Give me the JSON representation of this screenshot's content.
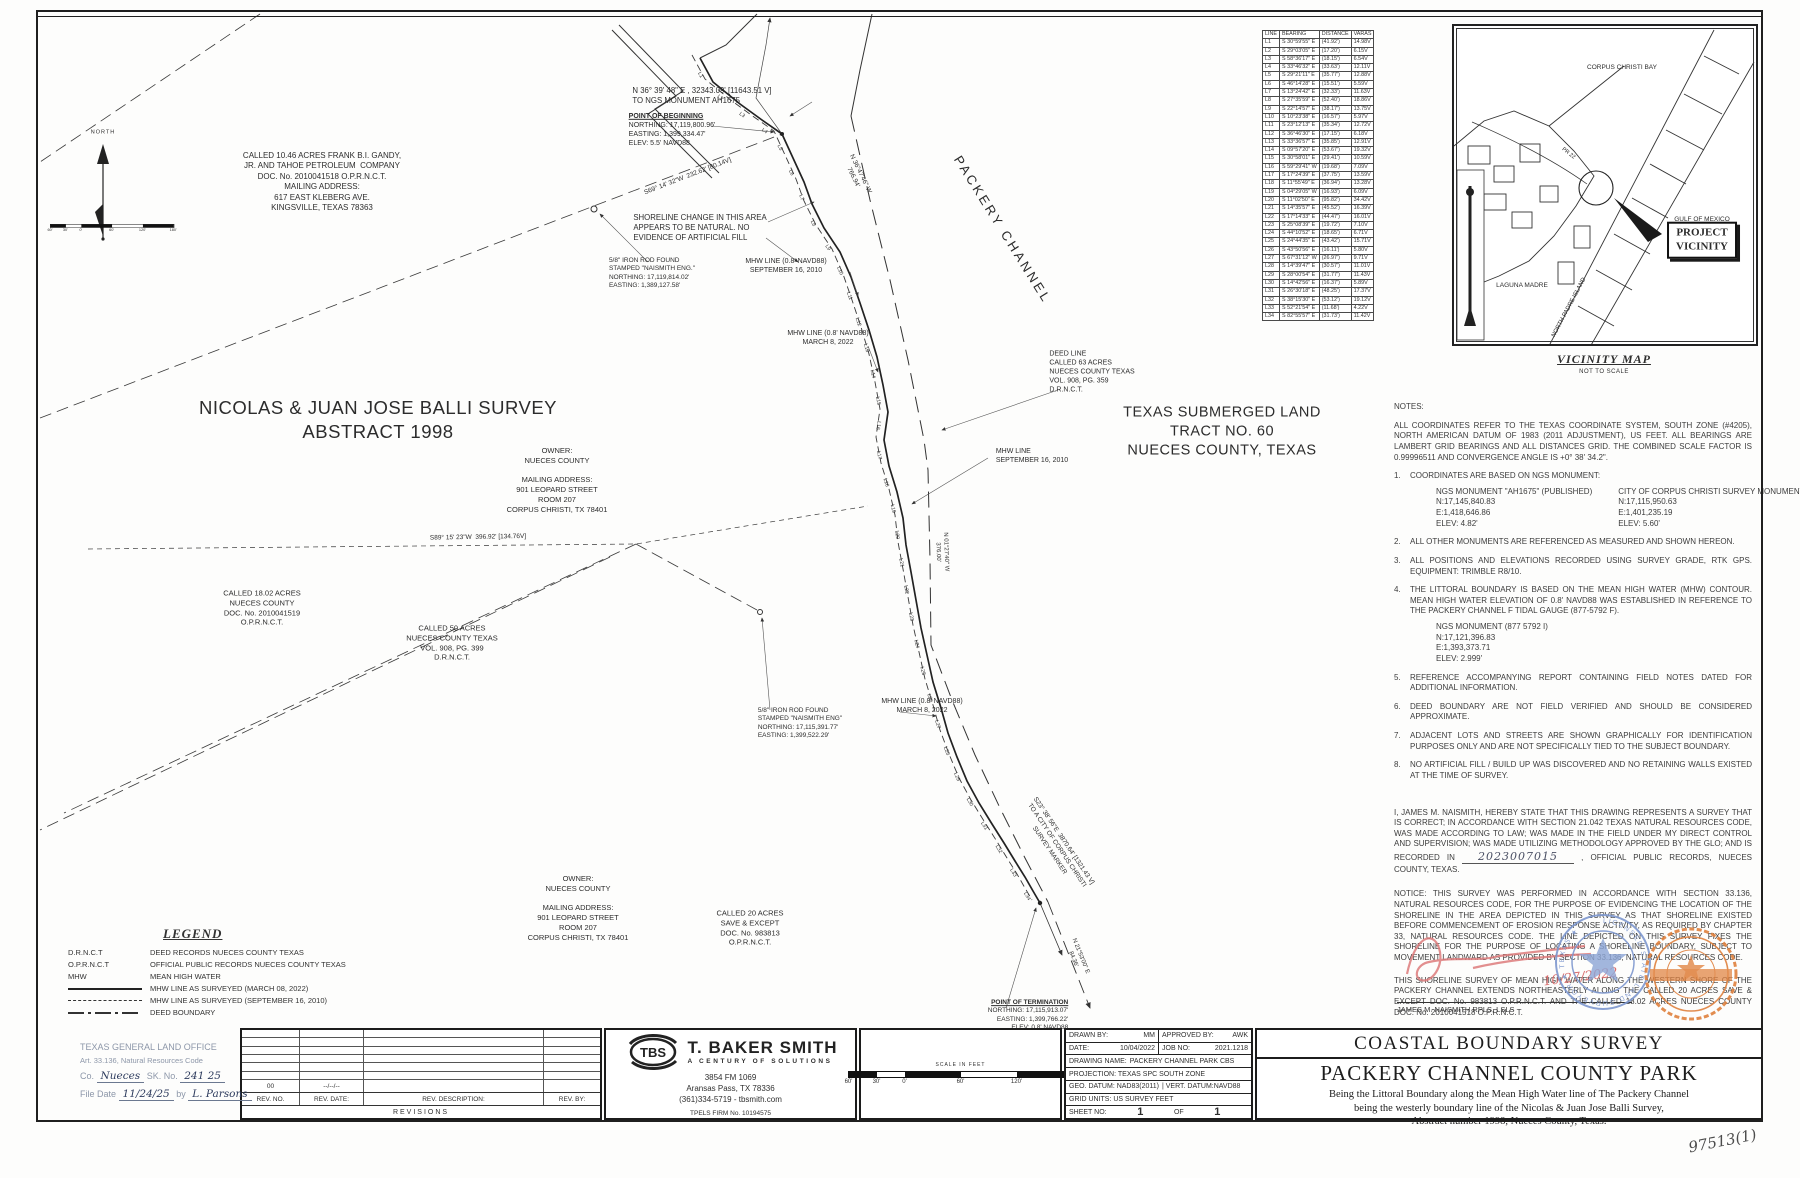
{
  "handnote": "97513(1)",
  "line_table": {
    "headers": [
      "LINE",
      "BEARING",
      "DISTANCE",
      "VARAS"
    ],
    "rows": [
      [
        "L1",
        "S 30°59'55\" E",
        "(41.92')",
        "14.98V"
      ],
      [
        "L2",
        "S 29°03'05\" E",
        "(17.20')",
        "6.15V"
      ],
      [
        "L3",
        "S 58°36'17\" E",
        "(18.15')",
        "6.54V"
      ],
      [
        "L4",
        "S 33°46'32\" E",
        "(33.63')",
        "12.11V"
      ],
      [
        "L5",
        "S 29°21'11\" E",
        "(35.77')",
        "12.88V"
      ],
      [
        "L6",
        "S 46°14'28\" E",
        "(15.51')",
        "5.59V"
      ],
      [
        "L7",
        "S 13°24'42\" E",
        "(32.33')",
        "11.63V"
      ],
      [
        "L8",
        "S 27°35'59\" E",
        "(52.40')",
        "18.86V"
      ],
      [
        "L9",
        "S 22°14'57\" E",
        "(38.17')",
        "13.75V"
      ],
      [
        "L10",
        "S 10°23'38\" E",
        "(16.57')",
        "5.97V"
      ],
      [
        "L11",
        "S 23°12'13\" E",
        "(35.34')",
        "12.72V"
      ],
      [
        "L12",
        "S 36°46'30\" E",
        "(17.15')",
        "6.18V"
      ],
      [
        "L13",
        "S 33°36'57\" E",
        "(35.85')",
        "12.91V"
      ],
      [
        "L14",
        "S 09°57'20\" E",
        "(53.67')",
        "19.32V"
      ],
      [
        "L15",
        "S 30°58'01\" E",
        "(29.41')",
        "10.59V"
      ],
      [
        "L16",
        "S 59°29'41\" W",
        "(19.68')",
        "7.09V"
      ],
      [
        "L17",
        "S 17°24'39\" E",
        "(37.75')",
        "13.59V"
      ],
      [
        "L18",
        "S 11°55'49\" E",
        "(36.94')",
        "13.28V"
      ],
      [
        "L19",
        "S 04°29'05\" W",
        "(16.93')",
        "6.09V"
      ],
      [
        "L20",
        "S 11°02'50\" E",
        "(95.82')",
        "34.42V"
      ],
      [
        "L21",
        "S 14°35'57\" E",
        "(45.52')",
        "16.39V"
      ],
      [
        "L22",
        "S 17°14'33\" E",
        "(44.47')",
        "16.01V"
      ],
      [
        "L23",
        "S 25°08'39\" E",
        "(19.72')",
        "7.10V"
      ],
      [
        "L24",
        "S 44°10'52\" E",
        "(18.65')",
        "6.71V"
      ],
      [
        "L25",
        "S 24°44'35\" E",
        "(43.42')",
        "15.71V"
      ],
      [
        "L26",
        "S 43°50'56\" E",
        "(16.11')",
        "5.80V"
      ],
      [
        "L27",
        "S 67°31'12\" W",
        "(26.97')",
        "9.71V"
      ],
      [
        "L28",
        "S 14°39'47\" E",
        "(30.57')",
        "11.01V"
      ],
      [
        "L29",
        "S 28°00'54\" E",
        "(31.77')",
        "11.43V"
      ],
      [
        "L30",
        "S 14°42'56\" E",
        "(16.37')",
        "5.89V"
      ],
      [
        "L31",
        "S 26°30'18\" E",
        "(48.25')",
        "17.37V"
      ],
      [
        "L32",
        "S 38°15'30\" E",
        "(53.12')",
        "19.12V"
      ],
      [
        "L33",
        "S 52°21'54\" E",
        "(11.68')",
        "4.22V"
      ],
      [
        "L34",
        "S 82°55'57\" E",
        "(31.73')",
        "11.42V"
      ]
    ]
  },
  "map": {
    "line_labels": [
      "L1",
      "L2",
      "L3",
      "L4",
      "L5",
      "L6",
      "L7",
      "L8",
      "L9",
      "L10",
      "L11",
      "L12",
      "L13",
      "L14",
      "L15",
      "L16",
      "L17",
      "L18",
      "L19",
      "L20",
      "L21",
      "L22",
      "L23",
      "L24",
      "L25",
      "L26",
      "L27",
      "L28",
      "L29",
      "L30",
      "L31",
      "L32",
      "L33",
      "L34"
    ],
    "labels": [
      {
        "n": "tract-1046-label",
        "t": "CALLED 10.46 ACRES FRANK B.I. GANDY,\nJR. AND TAHOE PETROLEUM  COMPANY\nDOC. No. 2010041518 O.P.R.N.C.T.\nMAILING ADDRESS:\n617 EAST KLEBERG AVE.\nKINGSVILLE, TEXAS 78363",
        "x": 322,
        "y": 182,
        "s": 8
      },
      {
        "n": "survey-name-label",
        "t": "NICOLAS & JUAN JOSE BALLI SURVEY\nABSTRACT 1998",
        "x": 378,
        "y": 420,
        "s": 18.5,
        "sp": 0.5
      },
      {
        "n": "owner-label-1",
        "t": "OWNER:\nNUECES COUNTY\n\nMAILING ADDRESS:\n901 LEOPARD STREET\nROOM 207\nCORPUS CHRISTI, TX 78401",
        "x": 557,
        "y": 480,
        "s": 7.5
      },
      {
        "n": "tract-1802-label",
        "t": "CALLED 18.02 ACRES\nNUECES COUNTY\nDOC. No. 2010041519\nO.P.R.N.C.T.",
        "x": 262,
        "y": 608,
        "s": 7.5
      },
      {
        "n": "tract-50-label",
        "t": "CALLED 50 ACRES\nNUECES COUNTY TEXAS\nVOL. 908, PG. 399\nD.R.N.C.T.",
        "x": 452,
        "y": 643,
        "s": 7.5
      },
      {
        "n": "submerged-tract-label",
        "t": "TEXAS SUBMERGED LAND\nTRACT NO. 60\nNUECES COUNTY, TEXAS",
        "x": 1222,
        "y": 432,
        "s": 14.5,
        "sp": 0.5
      },
      {
        "n": "packery-channel-label",
        "t": "PACKERY CHANNEL",
        "x": 1002,
        "y": 230,
        "s": 13,
        "r": 58,
        "sp": 3
      },
      {
        "n": "deed-line-label",
        "t": "DEED LINE\nCALLED 63 ACRES\nNUECES COUNTY TEXAS\nVOL. 908, PG. 359\nD.R.N.C.T.",
        "x": 1092,
        "y": 372,
        "s": 7,
        "a": "l"
      },
      {
        "n": "mhw-2010-label-mid",
        "t": "MHW LINE\nSEPTEMBER 16, 2010",
        "x": 1032,
        "y": 456,
        "s": 7,
        "a": "l"
      },
      {
        "n": "mhw-2022-label-upper",
        "t": "MHW LINE (0.8' NAVD88)\nMARCH 8, 2022",
        "x": 828,
        "y": 338,
        "s": 7
      },
      {
        "n": "mhw-2010-label-upper",
        "t": "MHW LINE (0.8' NAVD88)\nSEPTEMBER 16, 2010",
        "x": 786,
        "y": 266,
        "s": 7
      },
      {
        "n": "shoreline-change-note",
        "t": "SHORELINE CHANGE IN THIS AREA\nAPPEARS TO BE NATURAL. NO\nEVIDENCE OF ARTIFICIAL FILL",
        "x": 700,
        "y": 228,
        "s": 7.8,
        "a": "l"
      },
      {
        "n": "ngs-tie-bearing",
        "t": "N 36° 39' 48\" E , 32343.09' [11643.51 V]\nTO NGS MONUMENT AH1675",
        "x": 702,
        "y": 96,
        "s": 7.8,
        "a": "l"
      },
      {
        "n": "point-of-beginning-label",
        "t": "POINT OF BEGINNING\nNORTHING: 17,119,800.96'\nEASTING: 1,399,334.47'\nELEV: 5.5' NAVD88",
        "x": 672,
        "y": 130,
        "s": 7,
        "a": "l",
        "u": 1
      },
      {
        "n": "iron-rod-label-north",
        "t": "5/8\" IRON ROD FOUND\nSTAMPED \"NAISMITH ENG.\"\nNORTHING: 17,119,814.02'\nEASTING: 1,389,127.58'",
        "x": 652,
        "y": 274,
        "s": 6.5,
        "a": "l"
      },
      {
        "n": "bearing-s69",
        "t": "S69° 14' 32\"W  232.62' [80.14V]",
        "x": 688,
        "y": 177,
        "s": 6.5,
        "r": -21
      },
      {
        "n": "bearing-n36",
        "t": "N 36°47'46\" W\n766.94'",
        "x": 856,
        "y": 176,
        "s": 6.5,
        "r": 64
      },
      {
        "n": "bearing-s89",
        "t": "S89° 15' 23\"W  396.92' [134.76V]",
        "x": 478,
        "y": 538,
        "s": 6.5,
        "r": -1
      },
      {
        "n": "tract-20-label",
        "t": "CALLED 20 ACRES\nSAVE & EXCEPT\nDOC. No. 983813\nO.P.R.N.C.T.",
        "x": 750,
        "y": 928,
        "s": 7.5
      },
      {
        "n": "owner-label-2",
        "t": "OWNER:\nNUECES COUNTY\n\nMAILING ADDRESS:\n901 LEOPARD STREET\nROOM 207\nCORPUS CHRISTI, TX 78401",
        "x": 578,
        "y": 908,
        "s": 7.5
      },
      {
        "n": "point-of-termination-label",
        "t": "POINT OF TERMINATION\nNORTHING: 17,115,913.07'\nEASTING: 1,399,766.22'\nELEV: 0.8' NAVD88",
        "x": 1028,
        "y": 1016,
        "s": 6.5,
        "a": "r",
        "u": 1
      },
      {
        "n": "iron-rod-label-south",
        "t": "5/8\" IRON ROD FOUND\nSTAMPED \"NAISMITH ENG\"\nNORTHING: 17,115,391.77'\nEASTING: 1,399,522.29'",
        "x": 800,
        "y": 724,
        "s": 6.5,
        "a": "l"
      },
      {
        "n": "mhw-2022-label-lower",
        "t": "MHW LINE (0.8' NAVD88)\nMARCH 8, 2022",
        "x": 922,
        "y": 706,
        "s": 7
      },
      {
        "n": "bearing-s23-tie",
        "t": "S23° 38' 56\"E  3870.64' [1321.43 V]\nTO A CITY OF CORPUS CHRISTI\nSURVEY MARKER",
        "x": 1056,
        "y": 846,
        "s": 6.5,
        "r": 56
      },
      {
        "n": "bearing-n21",
        "t": "N 21°53'00\" E\n84.36'",
        "x": 1076,
        "y": 958,
        "s": 6,
        "r": 68
      },
      {
        "n": "bearing-n01",
        "t": "N 01°27'40\" W\n376.00'",
        "x": 941,
        "y": 552,
        "s": 6,
        "r": 88
      },
      {
        "n": "north-label",
        "t": "NORTH",
        "x": 103,
        "y": 133,
        "s": 5.5,
        "sp": 1
      }
    ]
  },
  "vicinity": {
    "labels": [
      {
        "n": "corpus-christi-bay-label",
        "t": "CORPUS CHRISTI BAY",
        "x": 168,
        "y": 42,
        "s": 6.5
      },
      {
        "n": "gulf-of-mexico-label",
        "t": "GULF OF MEXICO",
        "x": 248,
        "y": 194,
        "s": 6.5
      },
      {
        "n": "laguna-madre-label",
        "t": "LAGUNA MADRE",
        "x": 68,
        "y": 260,
        "s": 6.5
      },
      {
        "n": "north-padre-island-label",
        "t": "NORTH PADRE ISLAND",
        "x": 116,
        "y": 282,
        "s": 6,
        "r": -62
      },
      {
        "n": "pr22-label",
        "t": "PR 22",
        "x": 114,
        "y": 128,
        "s": 5.5,
        "r": 38
      },
      {
        "n": "project-vicinity-box",
        "t": "PROJECT\nVICINITY",
        "x": 248,
        "y": 214,
        "s": 11,
        "box": 1
      }
    ],
    "cap": "VICINITY MAP",
    "sub": "NOT TO SCALE"
  },
  "notes": {
    "cert": {
      "pre": "I, JAMES M. NAISMITH, HEREBY STATE THAT THIS DRAWING REPRESENTS A SURVEY THAT IS CORRECT; IN ACCORDANCE WITH SECTION 21.042 TEXAS NATURAL RESOURCES CODE, WAS MADE ACCORDING TO LAW; WAS MADE IN THE FIELD UNDER MY DIRECT CONTROL AND SUPERVISION; WAS MADE UTILIZING METHODOLOGY APPROVED BY THE GLO; AND IS RECORDED IN",
      "hand": "2023007015",
      "post": ", OFFICIAL PUBLIC RECORDS, NUECES COUNTY, TEXAS."
    },
    "blocks": [
      {
        "k": "h",
        "t": "NOTES:"
      },
      {
        "k": "p",
        "t": "ALL COORDINATES REFER TO THE TEXAS COORDINATE SYSTEM, SOUTH ZONE (#4205), NORTH AMERICAN DATUM OF 1983 (2011 ADJUSTMENT), US FEET. ALL BEARINGS ARE LAMBERT GRID BEARINGS AND ALL DISTANCES GRID. THE COMBINED SCALE FACTOR IS 0.99996511 AND CONVERGENCE ANGLE IS +0° 38' 34.2\"."
      },
      {
        "k": "n",
        "n": "1.",
        "t": "COORDINATES ARE BASED ON NGS MONUMENT:",
        "cols": [
          [
            "NGS MONUMENT \"AH1675\" (PUBLISHED)",
            "N:17,145,840.83",
            "E:1,418,646.86",
            "ELEV: 4.82'"
          ],
          [
            "CITY OF CORPUS CHRISTI SURVEY MONUMENT",
            "N:17,115,950.63",
            "E:1,401,235.19",
            "ELEV: 5.60'"
          ]
        ]
      },
      {
        "k": "n",
        "n": "2.",
        "t": "ALL OTHER MONUMENTS ARE REFERENCED AS MEASURED AND SHOWN HEREON."
      },
      {
        "k": "n",
        "n": "3.",
        "t": "ALL POSITIONS AND ELEVATIONS RECORDED USING SURVEY GRADE, RTK GPS. EQUIPMENT: TRIMBLE R8/10."
      },
      {
        "k": "n",
        "n": "4.",
        "t": "THE LITTORAL BOUNDARY IS BASED ON THE MEAN HIGH WATER (MHW) CONTOUR. MEAN HIGH WATER ELEVATION OF 0.8' NAVD88 WAS ESTABLISHED IN REFERENCE TO THE PACKERY CHANNEL F TIDAL GAUGE (877-5792 F).",
        "sub": [
          "NGS MONUMENT (877 5792 I)",
          "N:17,121,396.83",
          "E:1,393,373.71",
          "ELEV: 2.999'"
        ]
      },
      {
        "k": "n",
        "n": "5.",
        "t": "REFERENCE ACCOMPANYING REPORT CONTAINING FIELD NOTES DATED   FOR ADDITIONAL INFORMATION."
      },
      {
        "k": "n",
        "n": "6.",
        "t": "DEED BOUNDARY ARE NOT FIELD VERIFIED AND SHOULD BE CONSIDERED APPROXIMATE."
      },
      {
        "k": "n",
        "n": "7.",
        "t": "ADJACENT LOTS AND STREETS ARE SHOWN GRAPHICALLY FOR IDENTIFICATION PURPOSES ONLY AND ARE NOT SPECIFICALLY TIED TO THE SUBJECT BOUNDARY."
      },
      {
        "k": "n",
        "n": "8.",
        "t": "NO ARTIFICIAL FILL / BUILD UP WAS DISCOVERED AND NO RETAINING WALLS EXISTED AT THE TIME OF SURVEY."
      },
      {
        "k": "gap",
        "h": 18
      },
      {
        "k": "cert"
      },
      {
        "k": "gap",
        "h": 6
      },
      {
        "k": "p",
        "t": "NOTICE:  THIS SURVEY WAS PERFORMED IN ACCORDANCE WITH SECTION 33.136, NATURAL RESOURCES CODE, FOR THE PURPOSE OF EVIDENCING THE LOCATION OF THE SHORELINE IN THE AREA DEPICTED IN THIS SURVEY AS THAT SHORELINE EXISTED BEFORE COMMENCEMENT OF EROSION RESPONSE ACTIVITY, AS REQUIRED BY CHAPTER 33, NATURAL RESOURCES CODE.  THE LINE DEPICTED ON THIS SURVEY FIXES THE SHORELINE FOR THE PURPOSE OF LOCATING A SHORELINE BOUNDARY, SUBJECT TO MOVEMENT LANDWARD AS PROVIDED BY SECTION 33.136, NATURAL RESOURCES CODE."
      },
      {
        "k": "gap",
        "h": 4
      },
      {
        "k": "p",
        "t": "THIS SHORELINE SURVEY OF MEAN HIGH WATER ALONG THE WESTERN SHORE OF THE PACKERY CHANNEL EXTENDS NORTHEASTERLY ALONG THE CALLED 20 ACRES SAVE & EXCEPT DOC. No. 983813 O.P.R.N.C.T. AND THE CALLED 18.02 ACRES NUECES COUNTY DOC. No. 2010041518 O.P.R.N.C.T."
      },
      {
        "k": "gap",
        "h": 6
      },
      {
        "k": "p",
        "t": "SURVEY DATE: MARCH 8, 2022 SURVEY"
      },
      {
        "k": "gap",
        "h": 4
      },
      {
        "k": "p",
        "t": "PERSONNEL: CLAY COTTLE, NATHAN MCCOLLOM"
      }
    ]
  },
  "signature": {
    "date": "10/27/2022",
    "name": "JAMES M. NAISMITH RPLS, LSLS"
  },
  "stamps": {
    "blue_text": "LICENSED STATE LAND SURVEYOR ★ TEXAS ★"
  },
  "legend": {
    "title": "LEGEND",
    "abbrs": [
      {
        "key": "D.R.N.C.T",
        "text": "DEED RECORDS NUECES COUNTY TEXAS"
      },
      {
        "key": "O.P.R.N.C.T",
        "text": "OFFICIAL PUBLIC RECORDS NUECES COUNTY TEXAS"
      },
      {
        "key": "MHW",
        "text": "MEAN HIGH WATER"
      }
    ],
    "lines": [
      {
        "style": "solid",
        "text": "MHW LINE AS SURVEYED (MARCH 08, 2022)"
      },
      {
        "style": "dash",
        "text": "MHW LINE AS SURVEYED (SEPTEMBER 16, 2010)"
      },
      {
        "style": "dashdot",
        "text": "DEED BOUNDARY"
      }
    ]
  },
  "glo": {
    "l1": "TEXAS GENERAL LAND OFFICE",
    "l2": "Art. 33.136, Natural Resources Code",
    "co_label": "Co.",
    "co": "Nueces",
    "sk_label": "SK. No.",
    "sk": "241 25",
    "fd_label": "File Date",
    "fd": "11/24/25",
    "by_label": "by",
    "by": "L. Parsons"
  },
  "revisions": {
    "rev_no": "00",
    "rev_date": "--/--/--",
    "rev_desc": "",
    "rev_by": "",
    "h1": "REV. NO.",
    "h2": "REV. DATE:",
    "h3": "REV. DESCRIPTION:",
    "h4": "REV. BY:",
    "caption": "REVISIONS"
  },
  "tbs": {
    "logo": "TBS",
    "name": "T. BAKER SMITH",
    "tag": "A CENTURY OF SOLUTIONS",
    "a1": "3854 FM 1069",
    "a2": "Aransas Pass, TX 78336",
    "a3": "(361)334-5719 - tbsmith.com",
    "firm": "TPELS FIRM No. 10194575"
  },
  "scalebar": {
    "title": "SCALE IN FEET",
    "ticks": [
      "60'",
      "30'",
      "0'",
      "60'",
      "120'",
      "180'"
    ]
  },
  "info": {
    "r1l": "DRAWN BY:",
    "r1v": "MM",
    "r1l2": "APPROVED BY:",
    "r1v2": "AWK",
    "r2l": "DATE:",
    "r2v": "10/04/2022",
    "r2l2": "JOB NO:",
    "r2v2": "2021.1218",
    "r3l": "DRAWING NAME:",
    "r3v": "PACKERY CHANNEL PARK CBS",
    "r4": "PROJECTION: TEXAS SPC SOUTH ZONE",
    "r5a": "GEO. DATUM: NAD83(2011)",
    "r5b": "| VERT. DATUM:NAVD88",
    "r6": "GRID UNITS:  US SURVEY FEET",
    "r7l": "SHEET NO:",
    "r7v": "1",
    "r7of": "OF",
    "r7v2": "1"
  },
  "title_block": {
    "l1": "COASTAL BOUNDARY SURVEY",
    "l2": "PACKERY CHANNEL COUNTY PARK",
    "l3": "Being the Littoral Boundary along the Mean High Water line of  The Packery Channel",
    "l4": "being the westerly boundary line of the Nicolas & Juan Jose Balli Survey,",
    "l5": "Abstract number 1998, Nueces County, Texas."
  }
}
